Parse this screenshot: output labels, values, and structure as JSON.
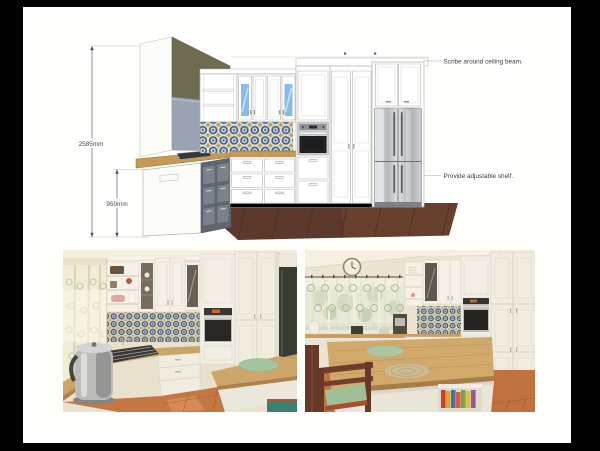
{
  "page": {
    "background": "#000000",
    "paper_color": "#fffffe"
  },
  "drawing": {
    "type": "kitchen-elevation-render",
    "dimensions": [
      {
        "id": "overall-height",
        "text": "2585mm"
      },
      {
        "id": "bench-height",
        "text": "950mm"
      }
    ],
    "annotations": [
      {
        "id": "ceiling-beam-note",
        "text": "Scribe around ceiling beam."
      },
      {
        "id": "adjustable-shelf-note",
        "text": "Provide adjustable shelf."
      }
    ],
    "colors": {
      "cabinetry": "#ffffff",
      "outline": "#b2b2ac",
      "bulkhead_olive": "#6e6b51",
      "window_gray_blue": "#9aa3b1",
      "glass_blue": "#8abaec",
      "tile_blue": "#3c5c90",
      "tile_tan": "#b3a167",
      "benchtop_wood": "#c59a55",
      "floor_timber": "#5c392b",
      "appliance_stainless": "#c9ccd0",
      "photo_floor_terracotta": "#c1703f"
    }
  }
}
